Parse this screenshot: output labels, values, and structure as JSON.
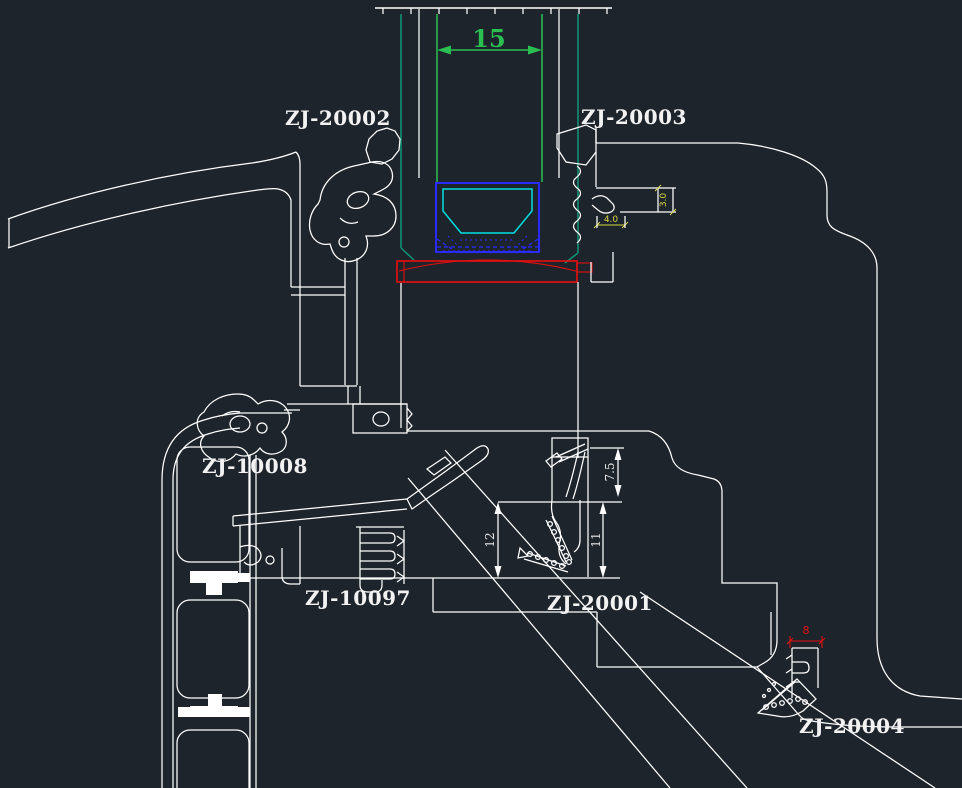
{
  "viewport": {
    "width": 962,
    "height": 788
  },
  "colors": {
    "background": "#1e242c",
    "line_white": "#ffffff",
    "dimension_green": "#2abf50",
    "channel_teal": "#0e9678",
    "gasket_cyan": "#00e0e0",
    "block_blue": "#2a2aff",
    "glass_red": "#e01010",
    "dim_yellow": "#d6d640"
  },
  "part_labels": [
    {
      "id": "zj-20002",
      "text": "ZJ-20002"
    },
    {
      "id": "zj-20003",
      "text": "ZJ-20003"
    },
    {
      "id": "zj-10008",
      "text": "ZJ-10008"
    },
    {
      "id": "zj-10097",
      "text": "ZJ-10097"
    },
    {
      "id": "zj-20001",
      "text": "ZJ-20001"
    },
    {
      "id": "zj-20004",
      "text": "ZJ-20004"
    }
  ],
  "dimensions": [
    {
      "id": "glazing-cavity-width",
      "text": "15",
      "color": "#2abf50"
    },
    {
      "id": "dim-7-5",
      "text": "7.5",
      "color": "#ffffff"
    },
    {
      "id": "dim-11",
      "text": "11",
      "color": "#ffffff"
    },
    {
      "id": "dim-12",
      "text": "12",
      "color": "#ffffff"
    },
    {
      "id": "dim-3-0",
      "text": "3.0",
      "color": "#d6d640"
    },
    {
      "id": "dim-4-0",
      "text": "4.0",
      "color": "#d6d640"
    },
    {
      "id": "dim-8",
      "text": "8",
      "color": "#e01010"
    }
  ]
}
